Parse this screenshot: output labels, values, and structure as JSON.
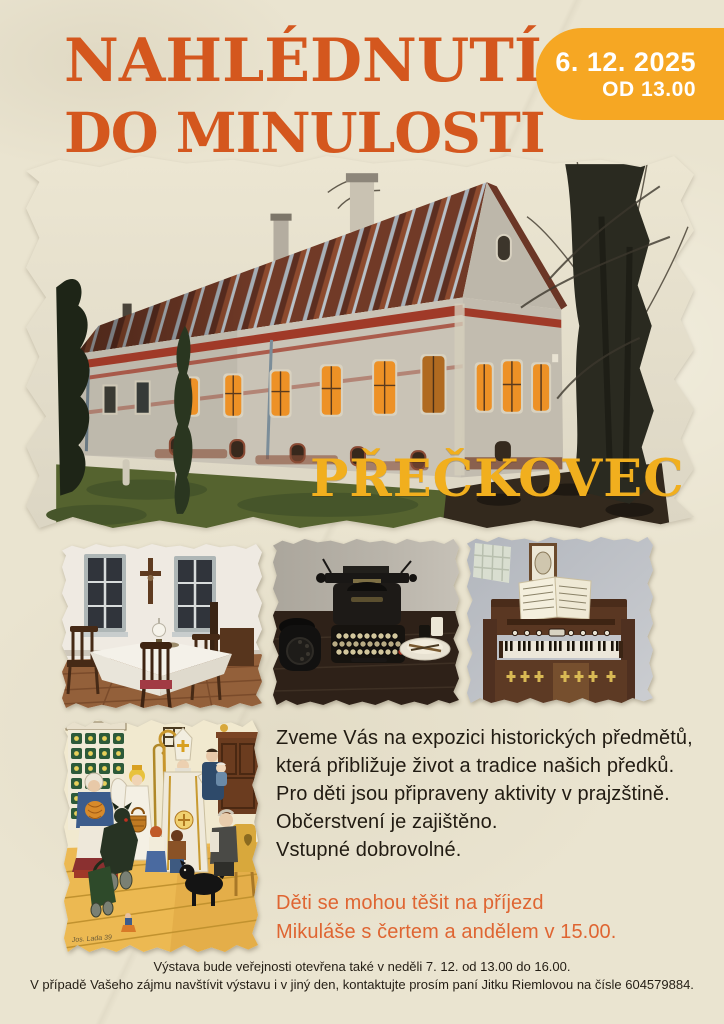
{
  "poster": {
    "background_color": "#EAE4D0",
    "header": {
      "title_line1": "NAHLÉDNUTÍ",
      "title_line2": "DO MINULOSTI",
      "title_line3": "STRAHOVIC",
      "title_color": "#D4571E"
    },
    "date_badge": {
      "date": "6. 12. 2025",
      "time": "OD 13.00",
      "background_color": "#F6A723",
      "text_color": "#FFFFFF"
    },
    "hero": {
      "caption": "PŘEČKOVEC",
      "caption_color": "#F1AF1E",
      "photo_label": "old-house-at-dusk-photo"
    },
    "gallery": {
      "photo1_label": "historic-dining-room-photo",
      "photo2_label": "vintage-typewriter-photo",
      "photo3_label": "harmonium-photo"
    },
    "painting": {
      "label": "mikulas-folk-painting",
      "signature": "Jos. Lada 39"
    },
    "body": {
      "text_color": "#211B12",
      "lines": [
        "Zveme Vás na expozici historických předmětů,",
        "která přibližuje život a tradice našich předků.",
        "Pro děti jsou připraveny aktivity v prajzštině.",
        "Občerstvení je zajištěno.",
        "Vstupné dobrovolné."
      ],
      "highlight_color": "#DF6532",
      "highlight_lines": [
        "Děti se mohou těšit na příjezd",
        "Mikuláše s čertem a andělem v 15.00."
      ]
    },
    "footer": {
      "lines": [
        "Výstava bude veřejnosti otevřena také v neděli 7. 12. od 13.00 do 16.00.",
        "V případě Vašeho zájmu navštívit výstavu i v jiný den, kontaktujte prosím paní Jitku Riemlovou na čísle 604579884."
      ]
    }
  }
}
